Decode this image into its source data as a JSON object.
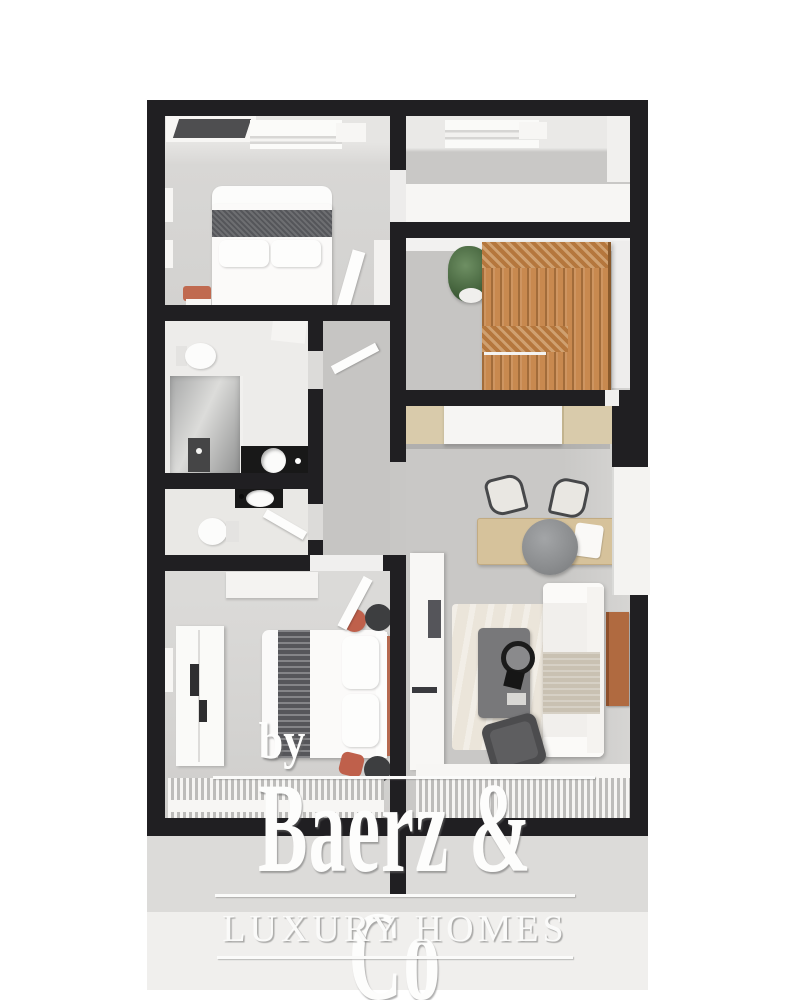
{
  "watermark": {
    "by": "by",
    "brand": "Baerz & Co",
    "tagline": "LUXURY HOMES"
  },
  "palette": {
    "wall": "#201f22",
    "floor_gray": "#cfcecc",
    "hall_gray": "#c6c5c3",
    "bathroom_floor": "#edecea",
    "wood_wardrobe": "#c8894f",
    "wood_kitchen": "#d9cbab",
    "dining_table_wood": "#d6c29b",
    "sideboard_wood": "#b06a40",
    "accent_coral": "#bf5f4a",
    "plant_green": "#47663f",
    "bed_band_gray": "#55565a",
    "backdrop_top": "#dcdbd9",
    "backdrop_bottom": "#f0efed",
    "watermark_white": "#fdfdfc"
  }
}
